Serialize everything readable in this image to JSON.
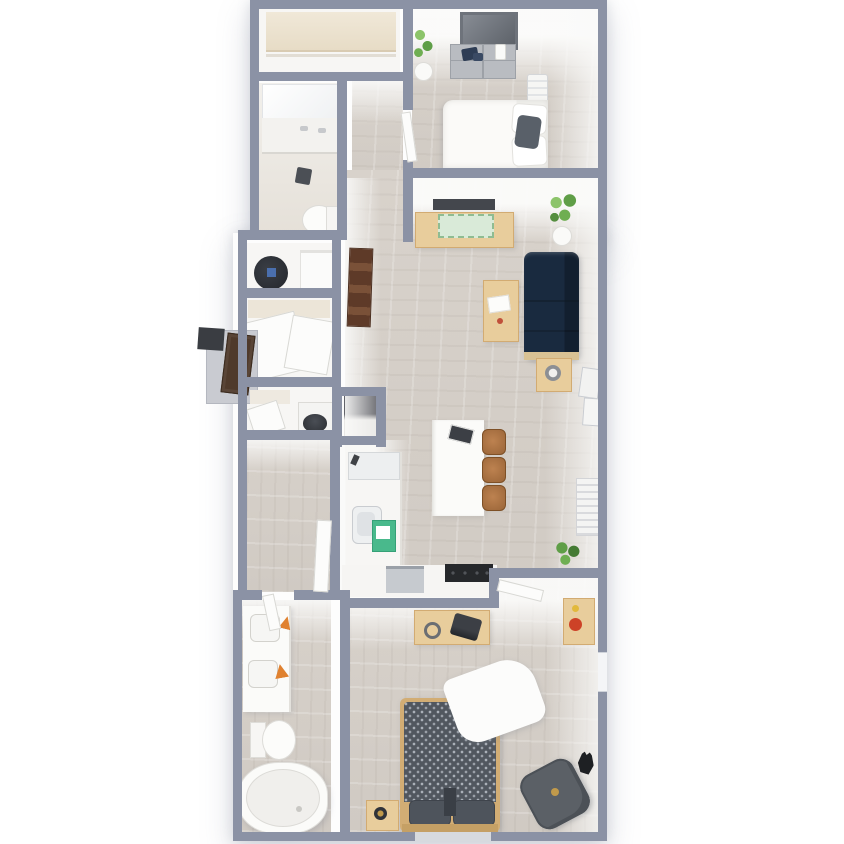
{
  "scene": {
    "type": "3d-floor-plan",
    "description": "Top-down 3D render of a one-line apartment: walk-in closet, bathroom and bedroom at top; living room, kitchen island and utility closets in the middle; second bathroom and second bedroom at the bottom.",
    "background": "#ffffff",
    "visible_text": ""
  },
  "colors": {
    "wall": "#8b92a5",
    "wallDark": "#7e8598",
    "floorWood": "#d6d0c9",
    "floorLight": "#eae7e2",
    "white": "#f7f6f4",
    "couch": "#4a6075",
    "couchDark": "#3d5266",
    "tan": "#e8cd9c",
    "tanDark": "#d2ab72",
    "ladder": "#5e3a28",
    "doorBrown": "#4f3a2b",
    "duvet": "#51575f",
    "pillowDark": "#4e545c",
    "chair": "#5b6066",
    "plant": "#5f9e47",
    "plantLight": "#8cc46a",
    "mint": "#49b98c",
    "orange": "#e0812f",
    "red": "#cd4227",
    "yellow": "#e2b93c",
    "steel": "#b9bcc1",
    "mirror": "#6e737b",
    "black": "#2d3036",
    "appliance": "#c6cacf",
    "gold": "#c19a4b"
  },
  "rooms": [
    {
      "id": "walk-in-closet",
      "position": "top-left"
    },
    {
      "id": "bathroom-1",
      "position": "upper-left",
      "fixtures": [
        "vanity",
        "mirror",
        "toilet"
      ]
    },
    {
      "id": "bedroom-1",
      "position": "top-right",
      "furniture": [
        "dresser",
        "mirror",
        "plant",
        "bed",
        "ac-unit"
      ]
    },
    {
      "id": "hallway-upper",
      "position": "upper-middle"
    },
    {
      "id": "living-room",
      "position": "middle-right",
      "furniture": [
        "tv",
        "console-table",
        "plants",
        "sofa",
        "coffee-table",
        "side-table",
        "wall-frames",
        "radiator",
        "ladder-shelf"
      ]
    },
    {
      "id": "kitchen",
      "position": "center",
      "furniture": [
        "counter",
        "fridge",
        "sink",
        "island",
        "bar-stools",
        "dishwasher",
        "stove"
      ]
    },
    {
      "id": "utility-closet",
      "position": "middle-left",
      "furniture": [
        "vacuum",
        "shelves",
        "wardrobe"
      ]
    },
    {
      "id": "entry",
      "position": "middle-left-exterior",
      "furniture": [
        "door",
        "step",
        "mat"
      ]
    },
    {
      "id": "laundry-closet",
      "position": "middle-left",
      "furniture": [
        "washer",
        "shelf"
      ]
    },
    {
      "id": "hallway-lower",
      "position": "lower-middle"
    },
    {
      "id": "bathroom-2",
      "position": "bottom-left",
      "fixtures": [
        "double-vanity",
        "toilet",
        "bathtub"
      ]
    },
    {
      "id": "bedroom-2",
      "position": "bottom-right",
      "furniture": [
        "desk",
        "typewriter",
        "art-dresser",
        "bed",
        "nightstand",
        "lamp",
        "armchair",
        "cat"
      ]
    }
  ]
}
